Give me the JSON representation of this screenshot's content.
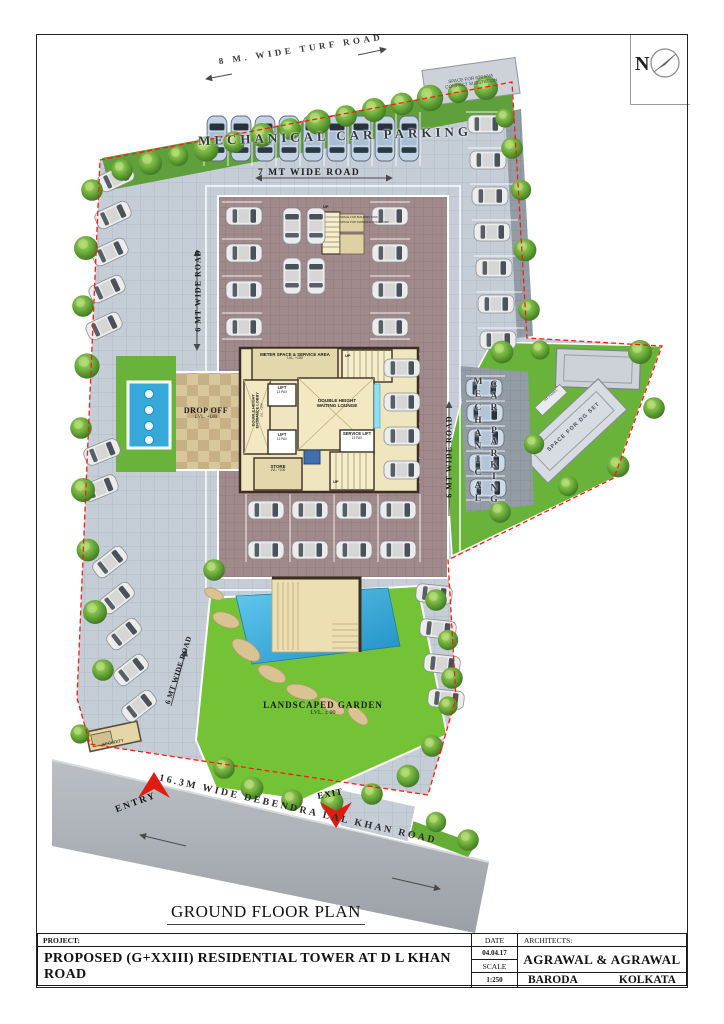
{
  "sheet": {
    "plan_title": "GROUND FLOOR PLAN",
    "north_label": "N"
  },
  "title_block": {
    "project_label": "PROJECT:",
    "project_name": "PROPOSED (G+XXIII) RESIDENTIAL TOWER AT D L KHAN ROAD",
    "date_label": "DATE",
    "date_value": "04.04.17",
    "scale_label": "SCALE",
    "scale_value": "1:250",
    "architects_label": "ARCHITECTS:",
    "architects_name": "AGRAWAL & AGRAWAL",
    "office_left": "BARODA",
    "office_right": "KOLKATA"
  },
  "roads": {
    "turf": "8 M. WIDE TURF ROAD",
    "seven_mt": "7 MT WIDE ROAD",
    "six_mt": "6 MT WIDE ROAD",
    "main": "16.3M WIDE DEBENDRA LAL KHAN ROAD"
  },
  "areas": {
    "mech_parking": "MECHANICAL CAR PARKING",
    "mech_vert_line1": "MECHANICAL",
    "mech_vert_line2": "CAR PARKING",
    "substation_line1": "SPACE FOR 630 KVA",
    "substation_line2": "COMPACT SUBSTATION",
    "drop_off": "DROP OFF",
    "drop_off_lvl": "LVL. +100",
    "garden": "LANDSCAPED GARDEN",
    "garden_lvl": "LVL. ± 00",
    "dg_set": "SPACE FOR DG SET",
    "ht_panel": "HT PANEL",
    "security": "SECURITY",
    "entry": "ENTRY",
    "exit": "EXIT",
    "building_tank": "SPACE FOR BUILDING TANK",
    "pool_pump": "SPACE FOR SWIMMING POOL PUMP"
  },
  "core": {
    "meter": "METER SPACE & SERVICE AREA",
    "lvl": "LVL. +100",
    "lift": "LIFT",
    "lift_cap": "13 PAX",
    "service_lift": "SERVICE LIFT",
    "lobby_line1": "DOUBLE HEIGHT",
    "lobby_line2": "ENTRANCE LOBBY",
    "lounge_line1": "DOUBLE HEIGHT",
    "lounge_line2": "WAITING LOUNGE",
    "store": "STORE",
    "up": "UP"
  },
  "colors": {
    "boundary_red": "#ff1a0e",
    "accent_red": "#e01b12",
    "paving": "#c5ced7",
    "podium": "#a18a8c",
    "garden_green": "#74c235",
    "water_blue": "#35a9da"
  }
}
